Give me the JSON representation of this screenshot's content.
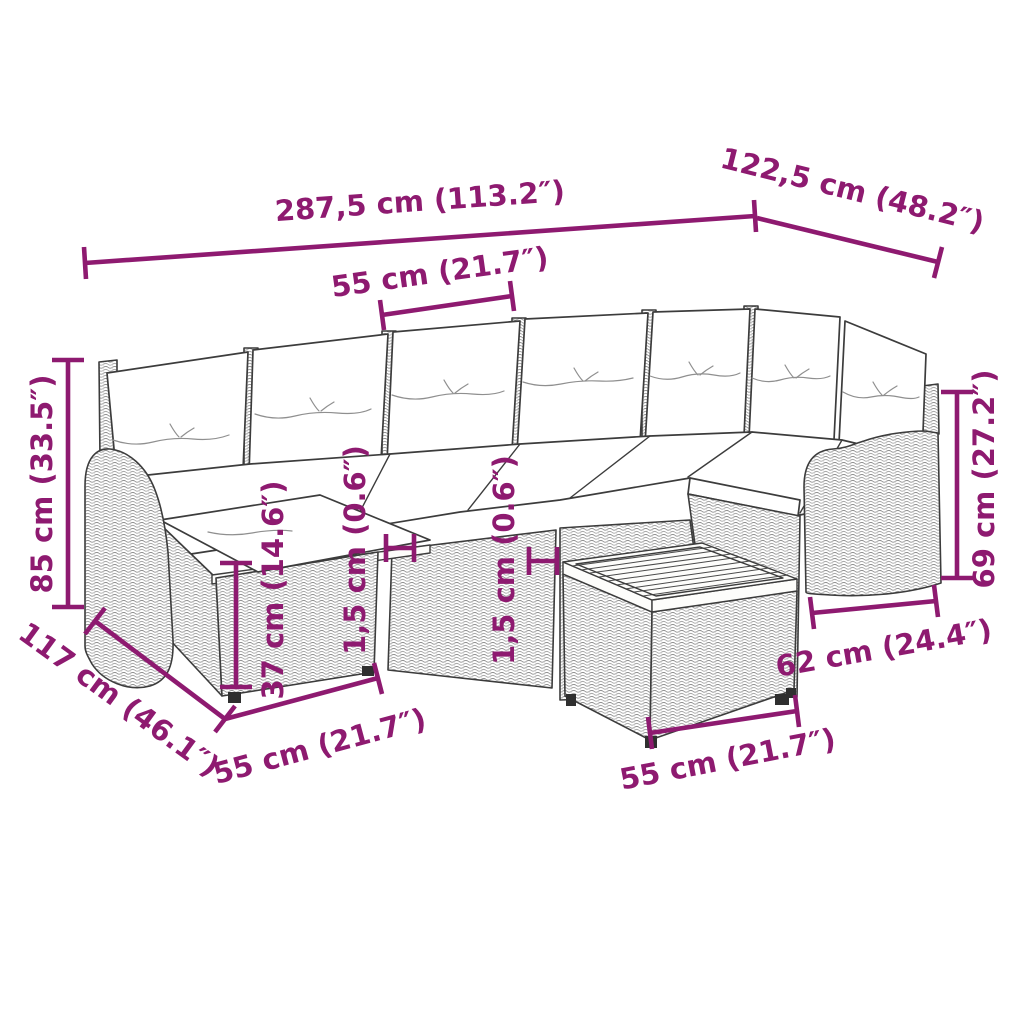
{
  "meta": {
    "description": "Dimension diagram of an L-shaped poly rattan garden lounge set with white cushions, footstool and square coffee table"
  },
  "colors": {
    "dimension": "#8e1a70",
    "outline": "#3c3c3c"
  },
  "dimensions": {
    "overall_width": "287,5 cm (113.2″)",
    "right_depth": "122,5 cm (48.2″)",
    "seat_width": "55 cm (21.7″)",
    "total_height": "85 cm (33.5″)",
    "left_depth": "117 cm (46.1″)",
    "seat_depth": "55 cm (21.7″)",
    "footstool_height": "37 cm (14.6″)",
    "gap_left": "1,5 cm (0.6″)",
    "gap_right": "1,5 cm (0.6″)",
    "back_height": "69 cm (27.2″)",
    "arm_section_width": "62 cm (24.4″)",
    "table_width": "55 cm (21.7″)"
  }
}
